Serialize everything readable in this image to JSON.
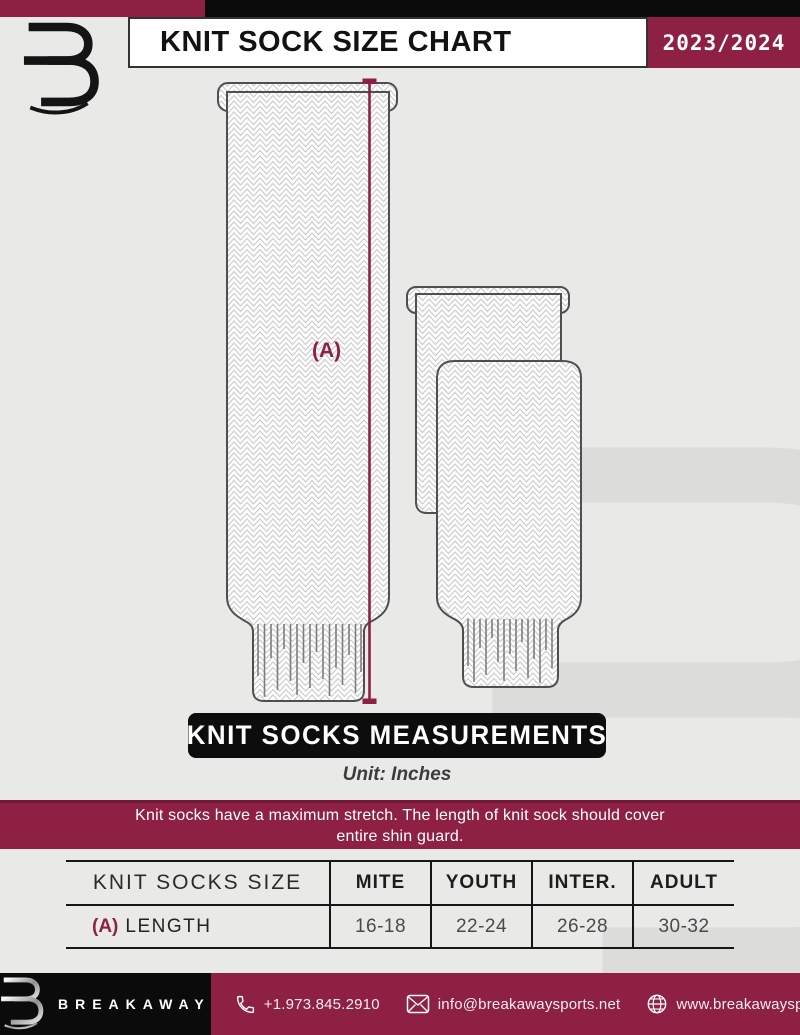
{
  "header": {
    "title": "KNIT SOCK SIZE CHART",
    "season": "2023/2024"
  },
  "diagram": {
    "measurement_label": "(A)"
  },
  "measurements": {
    "title": "KNIT SOCKS MEASUREMENTS",
    "unit": "Unit: Inches"
  },
  "notice": {
    "line1": "Knit socks have a maximum stretch. The length of knit sock should cover",
    "line2": "entire shin guard."
  },
  "size_table": {
    "header": [
      "KNIT SOCKS SIZE",
      "MITE",
      "YOUTH",
      "INTER.",
      "ADULT"
    ],
    "row": {
      "label_prefix": "(A)",
      "label": "LENGTH",
      "values": [
        "16-18",
        "22-24",
        "26-28",
        "30-32"
      ]
    }
  },
  "footer": {
    "brand": "BREAKAWAY",
    "phone": "+1.973.845.2910",
    "email": "info@breakawaysports.net",
    "website": "www.breakawaysports.net"
  },
  "icons": {
    "phone": "phone-icon",
    "email": "envelope-icon",
    "website": "globe-icon"
  },
  "colors": {
    "maroon": "#8d2043",
    "background": "#e9e9e8",
    "banner_black": "#0d0d0d",
    "sock_outline": "#4f4f4f"
  }
}
